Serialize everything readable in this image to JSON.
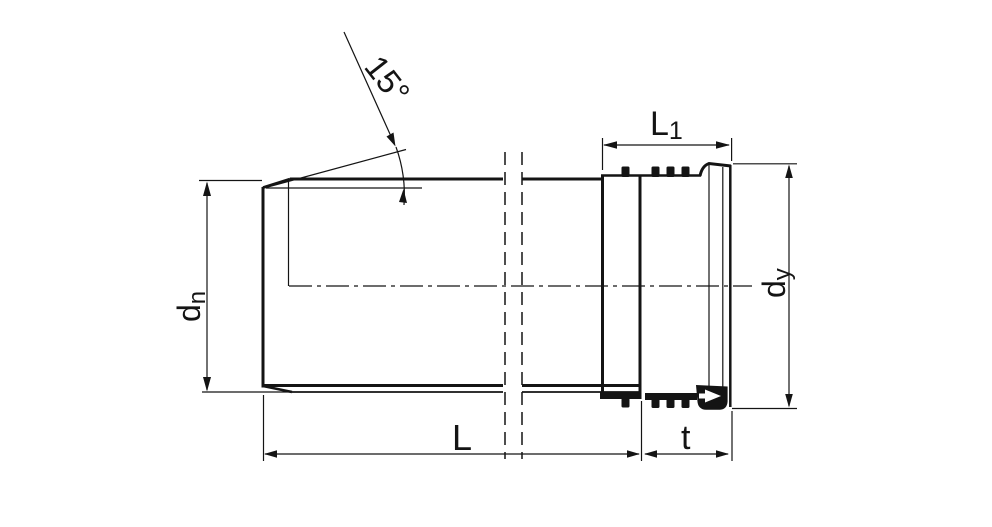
{
  "drawing": {
    "type": "technical-drawing",
    "subject": "pipe with push-fit socket, side view with half section"
  },
  "labels": {
    "chamfer_angle": "15°",
    "socket_length_base": "L",
    "socket_length_sub": "1",
    "outer_diameter_base": "d",
    "outer_diameter_sub": "n",
    "socket_diameter_base": "d",
    "socket_diameter_sub": "y",
    "total_length": "L",
    "insertion_depth": "t"
  },
  "colors": {
    "line": "#141414",
    "background": "#ffffff"
  }
}
